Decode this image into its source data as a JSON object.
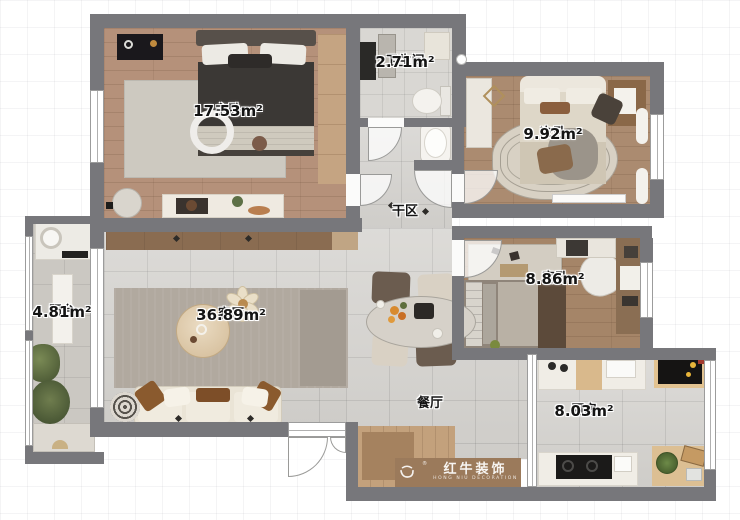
{
  "plan": {
    "rooms": [
      {
        "id": "master",
        "name": "主卧",
        "area": "17.53m²"
      },
      {
        "id": "bathroom",
        "name": "卫生间",
        "area": "2.71m²"
      },
      {
        "id": "second",
        "name": "次卧",
        "area": "9.92m²"
      },
      {
        "id": "dryarea",
        "name": "干区",
        "area": ""
      },
      {
        "id": "guest",
        "name": "客卧",
        "area": "8.86m²"
      },
      {
        "id": "balcony",
        "name": "阳台",
        "area": "4.81m²"
      },
      {
        "id": "living",
        "name": "客厅",
        "area": "36.89m²"
      },
      {
        "id": "dining",
        "name": "餐厅",
        "area": ""
      },
      {
        "id": "kitchen",
        "name": "厨房",
        "area": "8.03m²"
      }
    ],
    "logo": {
      "brand": "红牛装饰",
      "subtitle": "HONG NIU DECORATION",
      "registered": "®",
      "icon": "bull-icon"
    },
    "colors": {
      "wall": "#77777b",
      "wood_floor": "#b5917a",
      "tile_floor": "#d5d3cf",
      "logo_bar": "#9b7a5b",
      "label_text": "#141414"
    }
  }
}
